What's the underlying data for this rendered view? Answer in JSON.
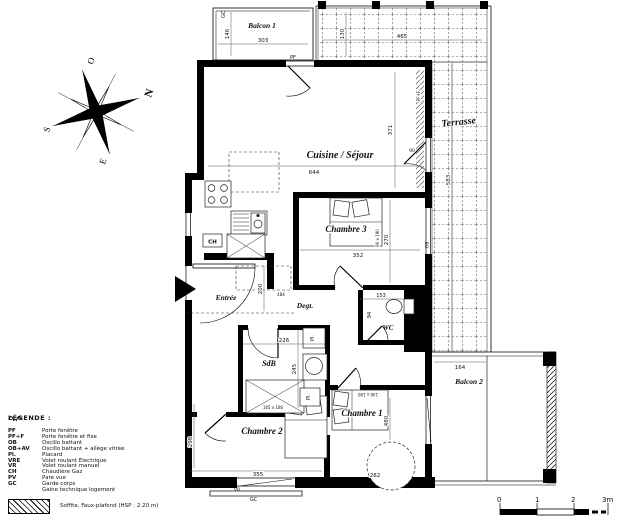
{
  "plan": {
    "compass": {
      "n": "N",
      "o": "O",
      "s": "S",
      "e": "E"
    },
    "balcon1": {
      "name": "Balcon 1",
      "width": "303",
      "height": "146",
      "rail": "GC",
      "door": "PF"
    },
    "terrasse": {
      "name": "Terrasse",
      "width": "465",
      "depth": "130",
      "height": "583",
      "window": "PF+F"
    },
    "sejour": {
      "name": "Cuisine / Séjour",
      "width": "644",
      "height": "371",
      "door_width": "90",
      "boiler": "CH"
    },
    "chambre3": {
      "name": "Chambre 3",
      "width": "352",
      "height": "270",
      "bed": "90 x 190",
      "window": "OB"
    },
    "entree": {
      "name": "Entrée",
      "height": "200",
      "width": "484"
    },
    "degt": {
      "name": "Degt."
    },
    "wc": {
      "name": "WC",
      "width": "153",
      "height": "94"
    },
    "sdb": {
      "name": "SdB",
      "width": "226",
      "height": "245",
      "bath": "165 x 180",
      "closet": "Pl."
    },
    "chambre2": {
      "name": "Chambre 2",
      "width": "355",
      "height": "298",
      "window": "VR",
      "rail": "GC"
    },
    "chambre1": {
      "name": "Chambre 1",
      "height": "480",
      "width": "282",
      "bed": "140 x 190",
      "closet": "Pl."
    },
    "balcon2": {
      "name": "Balcon 2",
      "width": "164"
    },
    "scale": {
      "t0": "0",
      "t1": "1",
      "t2": "2",
      "t3": "3m"
    }
  },
  "legend": {
    "title": "LÉGENDE :",
    "items": [
      {
        "abbr": "PF",
        "label": "Porte fenêtre"
      },
      {
        "abbr": "PF+F",
        "label": "Porte fenêtre et fixe"
      },
      {
        "abbr": "OB",
        "label": "Oscillo battant"
      },
      {
        "abbr": "OB+AV",
        "label": "Oscillo battant + allège vitrée"
      },
      {
        "abbr": "Pl.",
        "label": "Placard"
      },
      {
        "abbr": "VRE",
        "label": "Volet roulant Electrique"
      },
      {
        "abbr": "VR",
        "label": "Volet roulant manuel"
      },
      {
        "abbr": "CH",
        "label": "Chaudière Gaz"
      },
      {
        "abbr": "PV",
        "label": "Pare vue"
      },
      {
        "abbr": "GC",
        "label": "Garde corps"
      },
      {
        "abbr": "",
        "label": "Gaine technique logement"
      }
    ],
    "soffite": "Soffite, Faux-plafond (HSP : 2.20 m)"
  }
}
